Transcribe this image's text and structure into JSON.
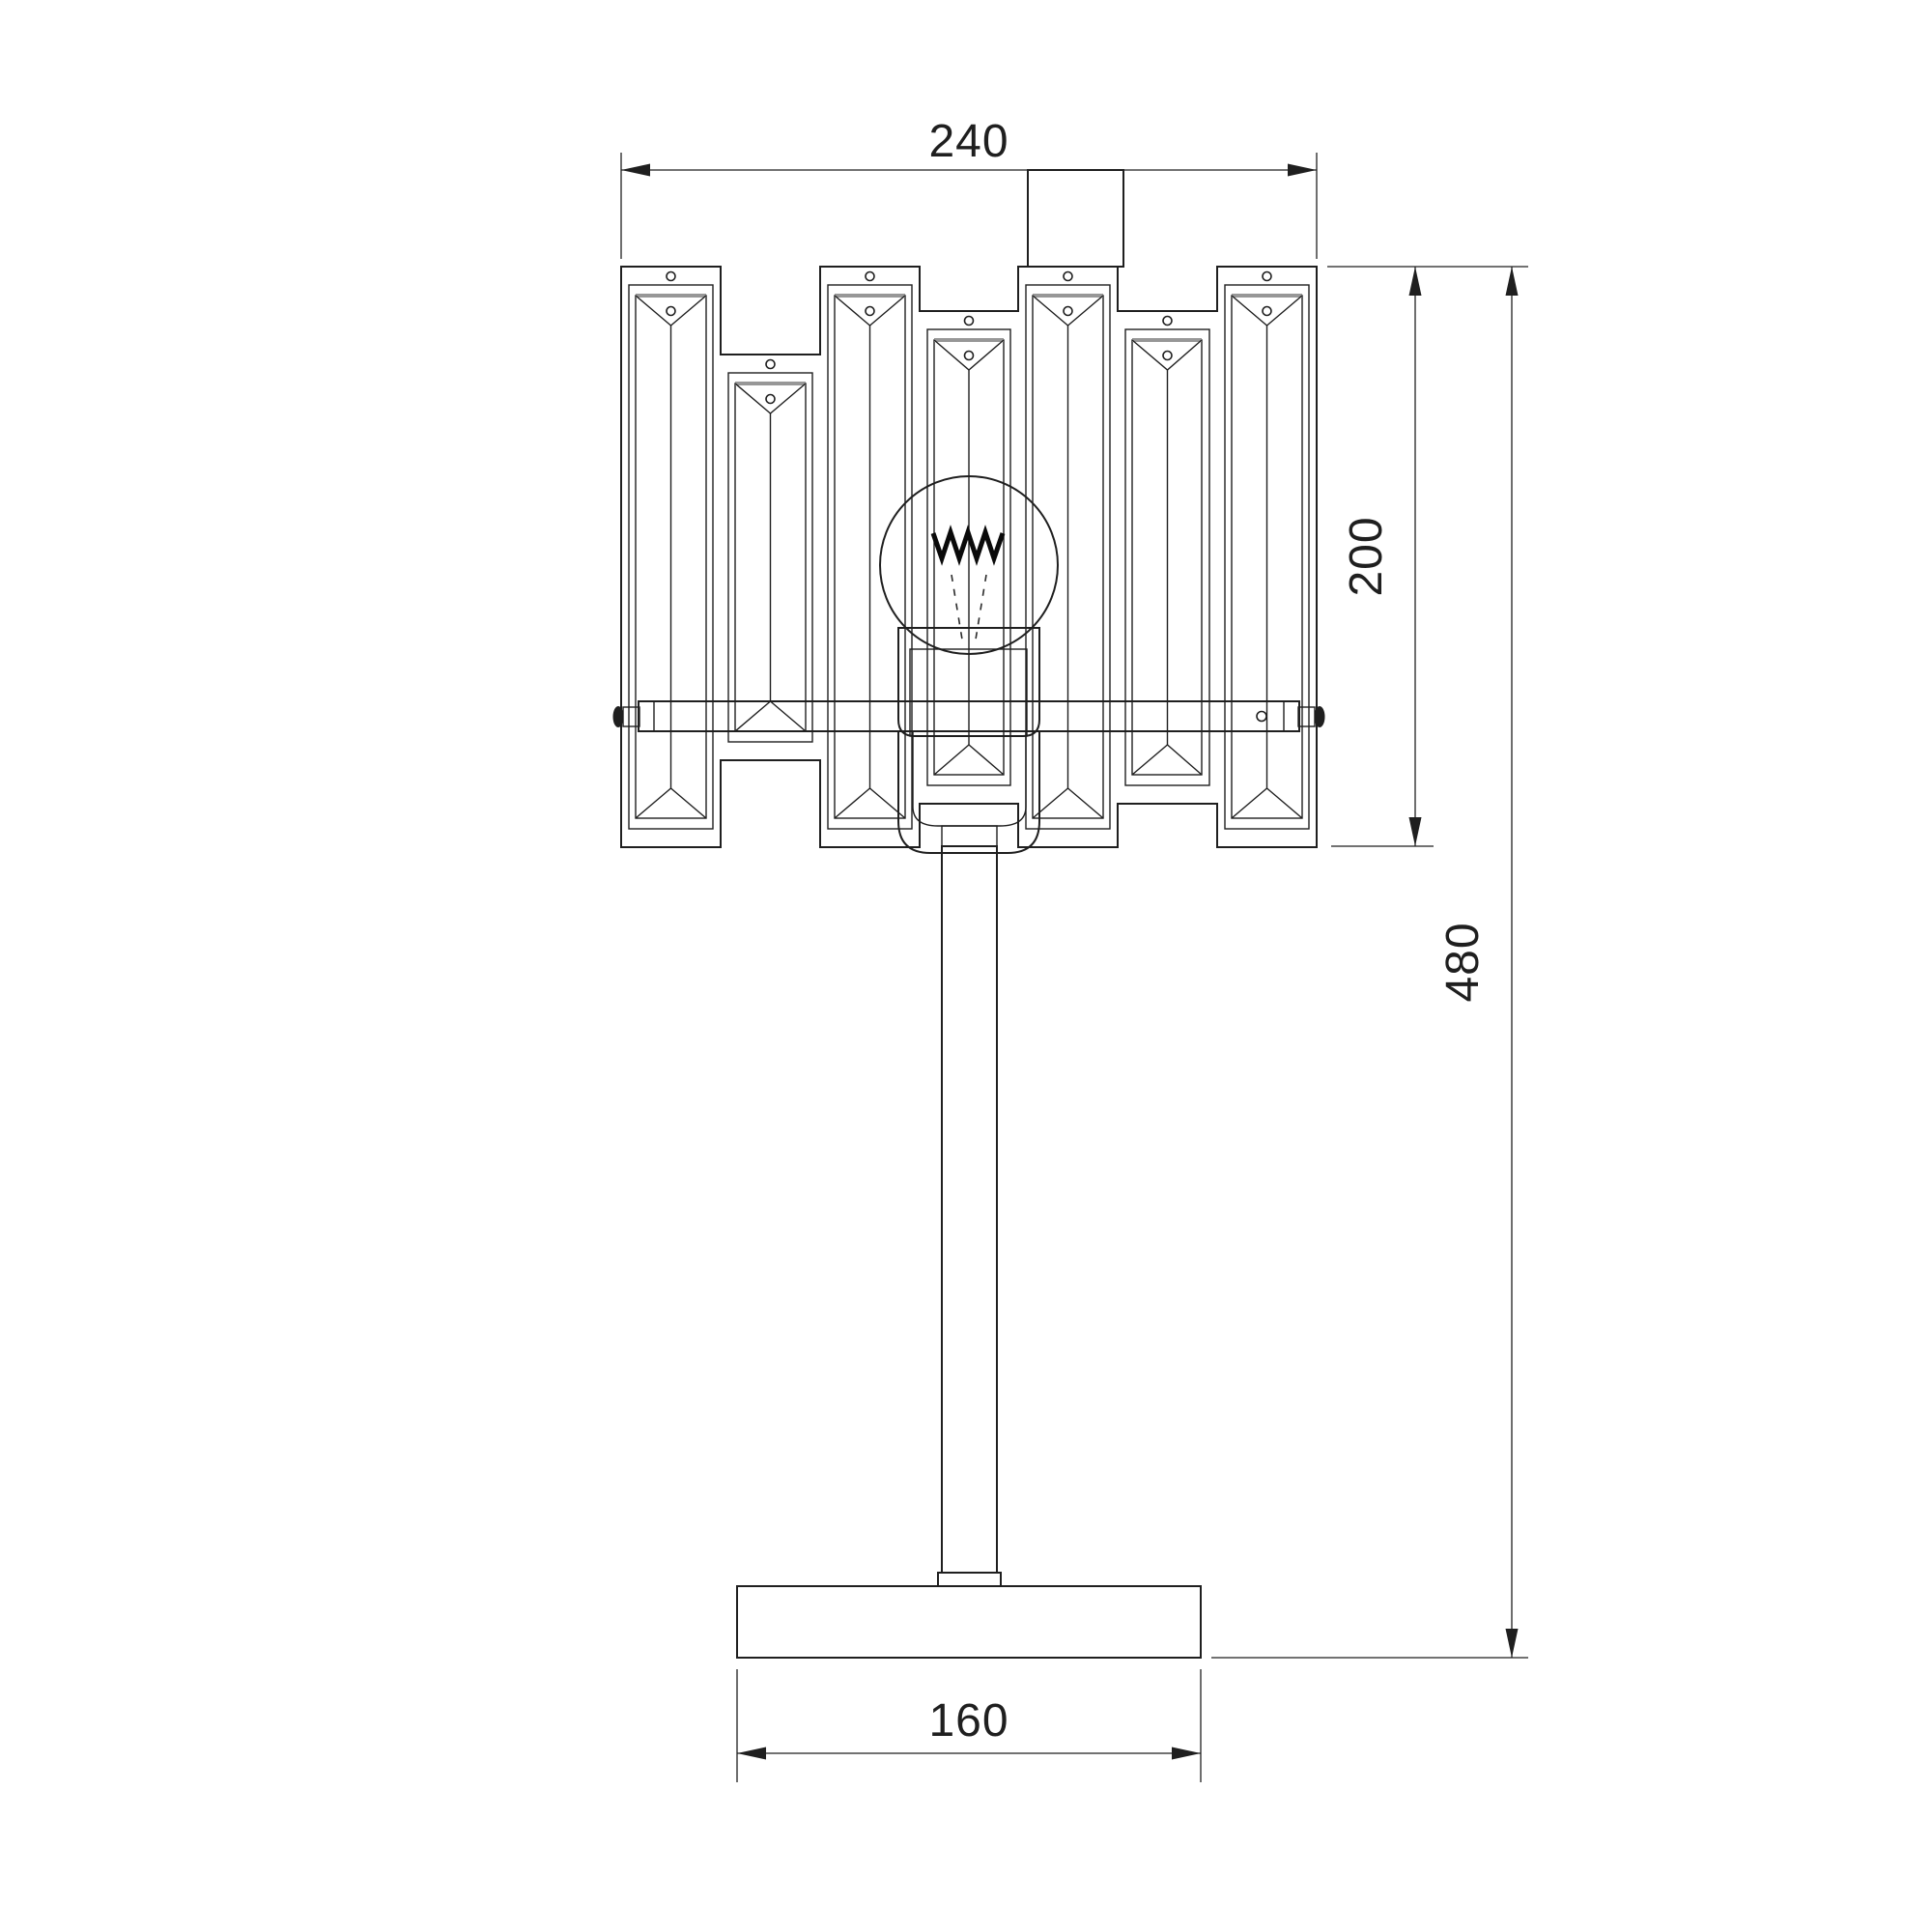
{
  "document": {
    "type": "technical-drawing",
    "subject": "crystal table lamp - front elevation",
    "background_color": "#ffffff",
    "line_color": "#1f1f1f"
  },
  "shade": {
    "panel_count": 7,
    "style": "alternating tall and recessed crystal prism panels"
  },
  "dimensions": {
    "shade_width": {
      "label": "240"
    },
    "shade_height": {
      "label": "200"
    },
    "total_height": {
      "label": "480"
    },
    "base_width": {
      "label": "160"
    }
  }
}
